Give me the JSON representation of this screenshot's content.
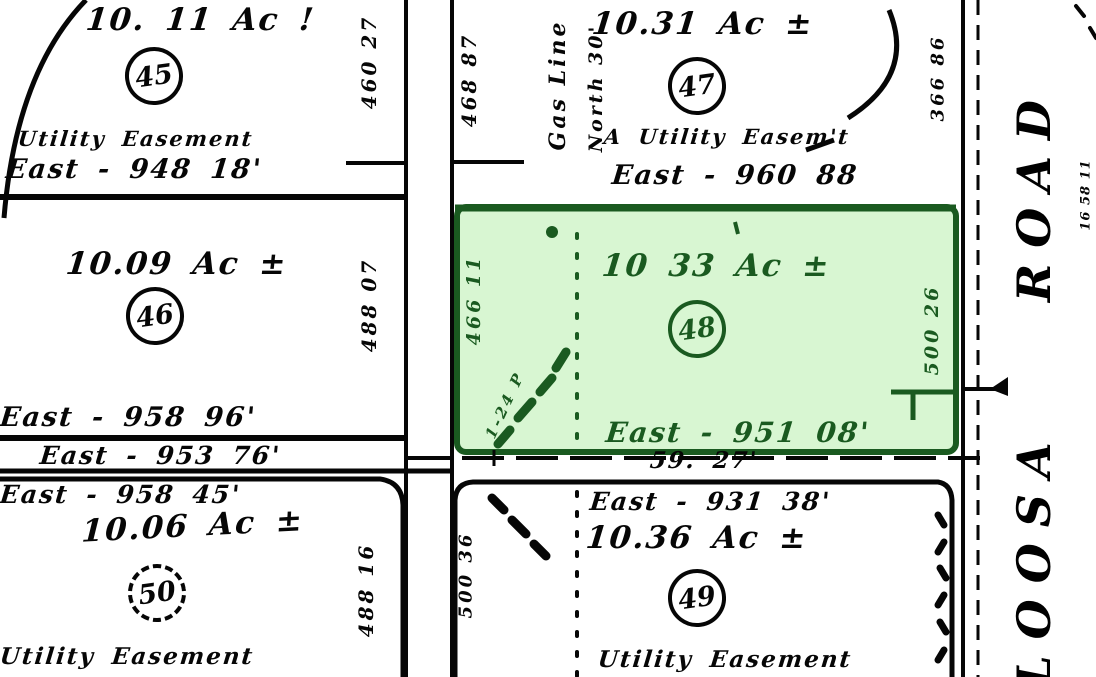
{
  "colors": {
    "paper": "#ffffff",
    "ink": "#060606",
    "highlight_fill": "#d8f6d2",
    "highlight_ink": "#1a5a20"
  },
  "parcels": {
    "p45": {
      "acreage": "10. 11 Ac !",
      "number": "45",
      "easement": "Utility Easement",
      "south_dim": "East - 948 18'"
    },
    "p46": {
      "acreage": "10.09 Ac ±",
      "number": "46",
      "south_dim": "East - 958 96'"
    },
    "p50": {
      "acreage": "10.06 Ac ±",
      "number": "50",
      "north_dim": "East - 958 45'",
      "easement": "Utility Easement"
    },
    "p47": {
      "acreage": "10.31 Ac ±",
      "number": "47",
      "easement": "A Utility Easem't",
      "south_dim": "East - 960 88",
      "gas_line_label": "Gas Line",
      "north_label": "North 30'",
      "east_dim": "366 86"
    },
    "p48": {
      "acreage": "10 33 Ac ±",
      "number": "48",
      "south_dim": "East - 951 08'",
      "west_dim": "466 11",
      "east_dim": "500 26",
      "note": "1-24 P",
      "highlighted": true
    },
    "p49": {
      "acreage": "10.36 Ac ±",
      "number": "49",
      "north_dim": "East - 931 38'",
      "easement": "Utility Easement",
      "west_dim": "500 36"
    }
  },
  "roads": {
    "middle_strip_dim": "East - 953 76'",
    "cross_strip_dim": "59. 27'",
    "north_road_dims": {
      "left_top": "460 27",
      "right_top": "468 87",
      "left_mid": "488 07",
      "left_bottom": "488 16"
    },
    "east_road": {
      "name_upper": "ROAD",
      "name_lower": "LOOSA",
      "edge_dim": "16 58 11"
    }
  }
}
